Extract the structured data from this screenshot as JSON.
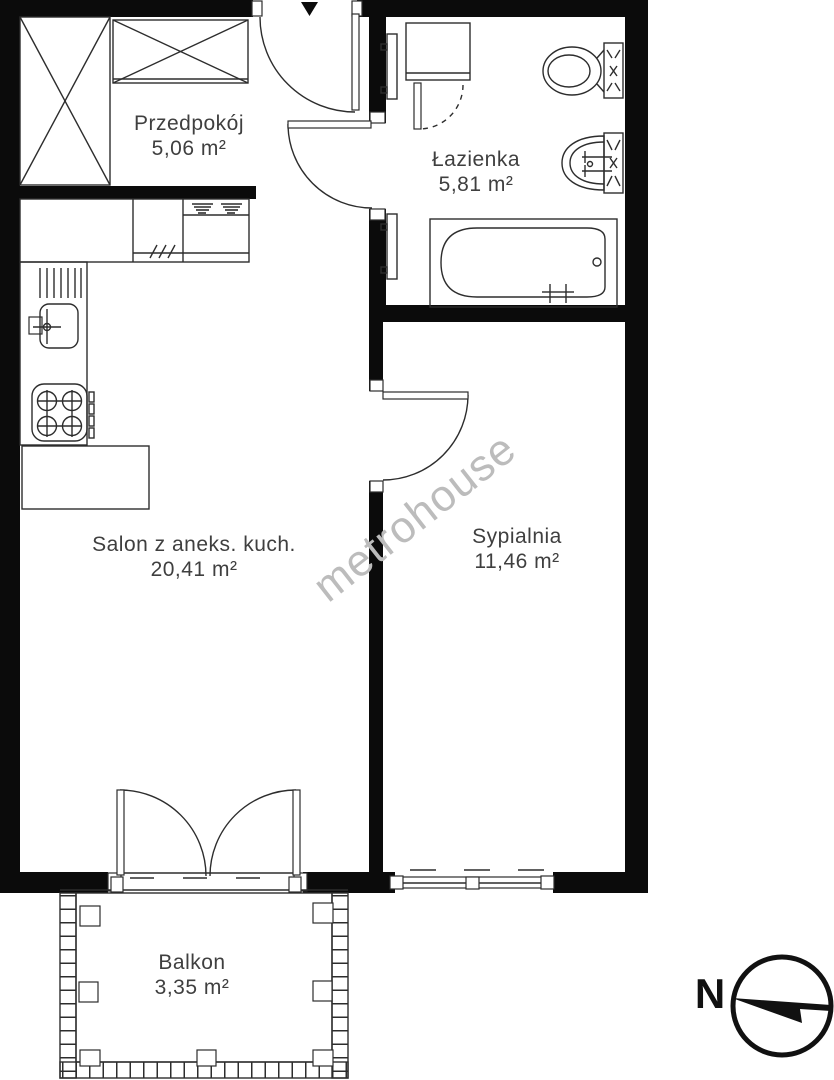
{
  "rooms": [
    {
      "name": "Przedpokój",
      "area": "5,06 m²"
    },
    {
      "name": "Łazienka",
      "area": "5,81 m²"
    },
    {
      "name": "Salon z aneks. kuch.",
      "area": "20,41 m²"
    },
    {
      "name": "Sypialnia",
      "area": "11,46 m²"
    },
    {
      "name": "Balkon",
      "area": "3,35 m²"
    }
  ],
  "watermark": {
    "text": "metrohouse",
    "color": "#bcbcbc"
  },
  "compass": {
    "north_label": "N"
  },
  "icons": {
    "entrance": "down-arrow-icon",
    "compass": "north-needle-icon"
  },
  "colors": {
    "wall": "#0b0b0b",
    "line": "#2d2d2d",
    "text": "#3f3f3f",
    "background": "#ffffff"
  }
}
